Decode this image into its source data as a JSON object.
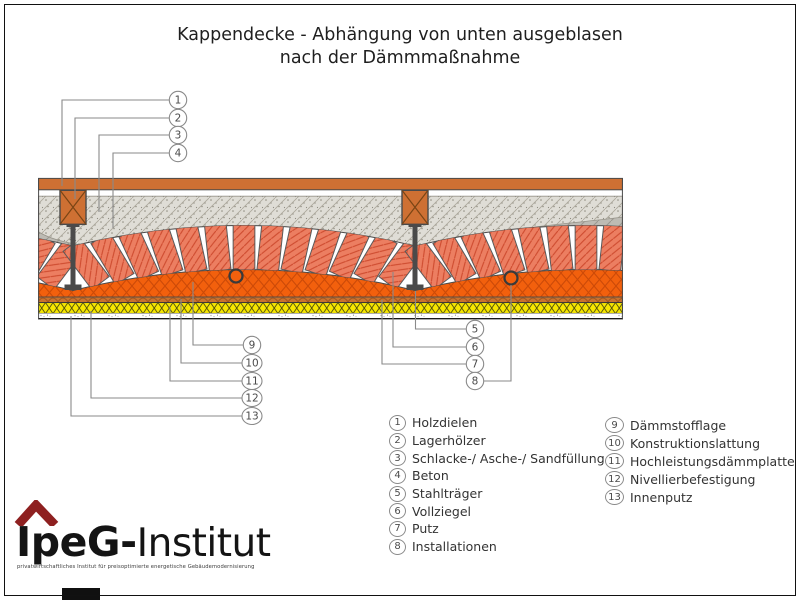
{
  "title": {
    "line1": "Kappendecke - Abhängung von unten ausgeblasen",
    "line2": "nach der Dämmmaßnahme"
  },
  "legend_left": [
    {
      "num": "1",
      "label": "Holzdielen"
    },
    {
      "num": "2",
      "label": "Lagerhölzer"
    },
    {
      "num": "3",
      "label": "Schlacke-/ Asche-/ Sandfüllung"
    },
    {
      "num": "4",
      "label": "Beton"
    },
    {
      "num": "5",
      "label": "Stahlträger"
    },
    {
      "num": "6",
      "label": "Vollziegel"
    },
    {
      "num": "7",
      "label": "Putz"
    },
    {
      "num": "8",
      "label": "Installationen"
    }
  ],
  "legend_right": [
    {
      "num": "9",
      "label": "Dämmstofflage"
    },
    {
      "num": "10",
      "label": "Konstruktionslattung"
    },
    {
      "num": "11",
      "label": "Hochleistungsdämmplatte"
    },
    {
      "num": "12",
      "label": "Nivellierbefestigung"
    },
    {
      "num": "13",
      "label": "Innenputz"
    }
  ],
  "logo": {
    "brand_bold": "IpeG-",
    "brand_rest": "Institut",
    "tagline": "privatwirtschaftliches Institut für preisoptimierte energetische Gebäudemodernisierung"
  },
  "colors": {
    "wood": "#CE7033",
    "fill_speckled": "#DFDDD6",
    "concrete": "#BDBBB4",
    "brick": "#EC7E61",
    "brick_hatch": "#CD4A2E",
    "insulation_blown": "#F2600D",
    "insulation_lattice": "#CC4A08",
    "batten": "#C8722F",
    "insulation_board": "#F6E600",
    "steel": "#4a4a4a",
    "leader": "#8a8a8a",
    "logo_red": "#8e2020"
  }
}
